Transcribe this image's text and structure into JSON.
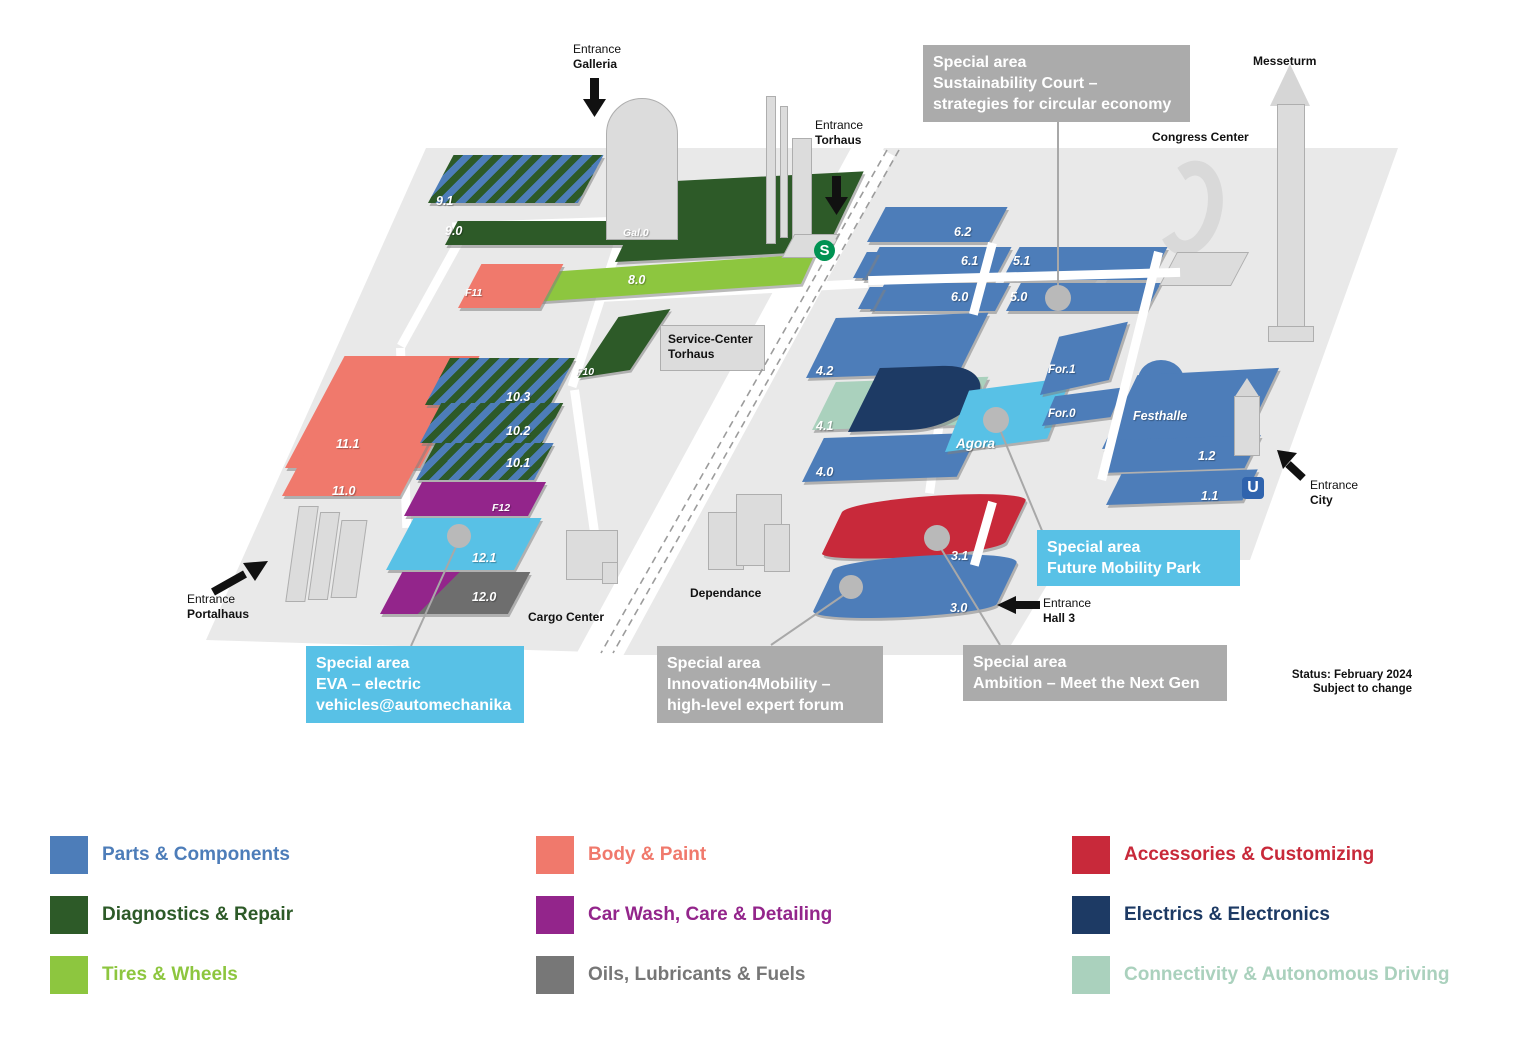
{
  "map": {
    "halls": {
      "h9_1": "9.1",
      "h9_0": "9.0",
      "gal0": "Gal.0",
      "h8_0": "8.0",
      "f11": "F11",
      "f10": "F10",
      "h11_1": "11.1",
      "h11_0": "11.0",
      "h10_3": "10.3",
      "h10_2": "10.2",
      "h10_1": "10.1",
      "f12": "F12",
      "h12_1": "12.1",
      "h12_0": "12.0",
      "h6_2": "6.2",
      "h6_1": "6.1",
      "h5_1": "5.1",
      "h6_0": "6.0",
      "h5_0": "5.0",
      "h4_2": "4.2",
      "h4_1": "4.1",
      "h4_0": "4.0",
      "agora": "Agora",
      "for1": "For.1",
      "for0": "For.0",
      "festhalle": "Festhalle",
      "h1_2": "1.2",
      "h1_1": "1.1",
      "h3_1": "3.1",
      "h3_0": "3.0"
    },
    "buildings": {
      "messeturm": "Messeturm",
      "congress_center": "Congress Center",
      "service_center_line1": "Service-Center",
      "service_center_line2": "Torhaus",
      "dependance": "Dependance",
      "cargo_center": "Cargo Center"
    },
    "entrances": {
      "galleria": {
        "line1": "Entrance",
        "line2": "Galleria"
      },
      "torhaus": {
        "line1": "Entrance",
        "line2": "Torhaus"
      },
      "portalhaus": {
        "line1": "Entrance",
        "line2": "Portalhaus"
      },
      "city": {
        "line1": "Entrance",
        "line2": "City"
      },
      "hall3": {
        "line1": "Entrance",
        "line2": "Hall 3"
      }
    },
    "transit": {
      "sbahn": "S",
      "ubahn": "U"
    },
    "special_areas": {
      "sustainability": {
        "title": "Special area",
        "line1": "Sustainability Court –",
        "line2": "strategies for circular economy"
      },
      "eva": {
        "title": "Special area",
        "line1": "EVA – electric",
        "line2": "vehicles@automechanika"
      },
      "innovation": {
        "title": "Special area",
        "line1": "Innovation4Mobility –",
        "line2": "high-level expert forum"
      },
      "ambition": {
        "title": "Special area",
        "line1": "Ambition – Meet the Next Gen"
      },
      "future_mobility": {
        "title": "Special area",
        "line1": "Future Mobility Park"
      }
    },
    "status": {
      "line1": "Status: February 2024",
      "line2": "Subject to change"
    }
  },
  "legend": {
    "items": [
      {
        "label": "Parts & Components",
        "color": "#4d7db9"
      },
      {
        "label": "Diagnostics & Repair",
        "color": "#2d5a28"
      },
      {
        "label": "Tires & Wheels",
        "color": "#8dc63f"
      },
      {
        "label": "Body & Paint",
        "color": "#f0796c"
      },
      {
        "label": "Car Wash, Care & Detailing",
        "color": "#93258b"
      },
      {
        "label": "Oils, Lubricants & Fuels",
        "color": "#777777"
      },
      {
        "label": "Accessories & Customizing",
        "color": "#c8293a"
      },
      {
        "label": "Electrics & Electronics",
        "color": "#1d3a64"
      },
      {
        "label": "Connectivity & Autonomous Driving",
        "color": "#aad1bd"
      }
    ]
  }
}
